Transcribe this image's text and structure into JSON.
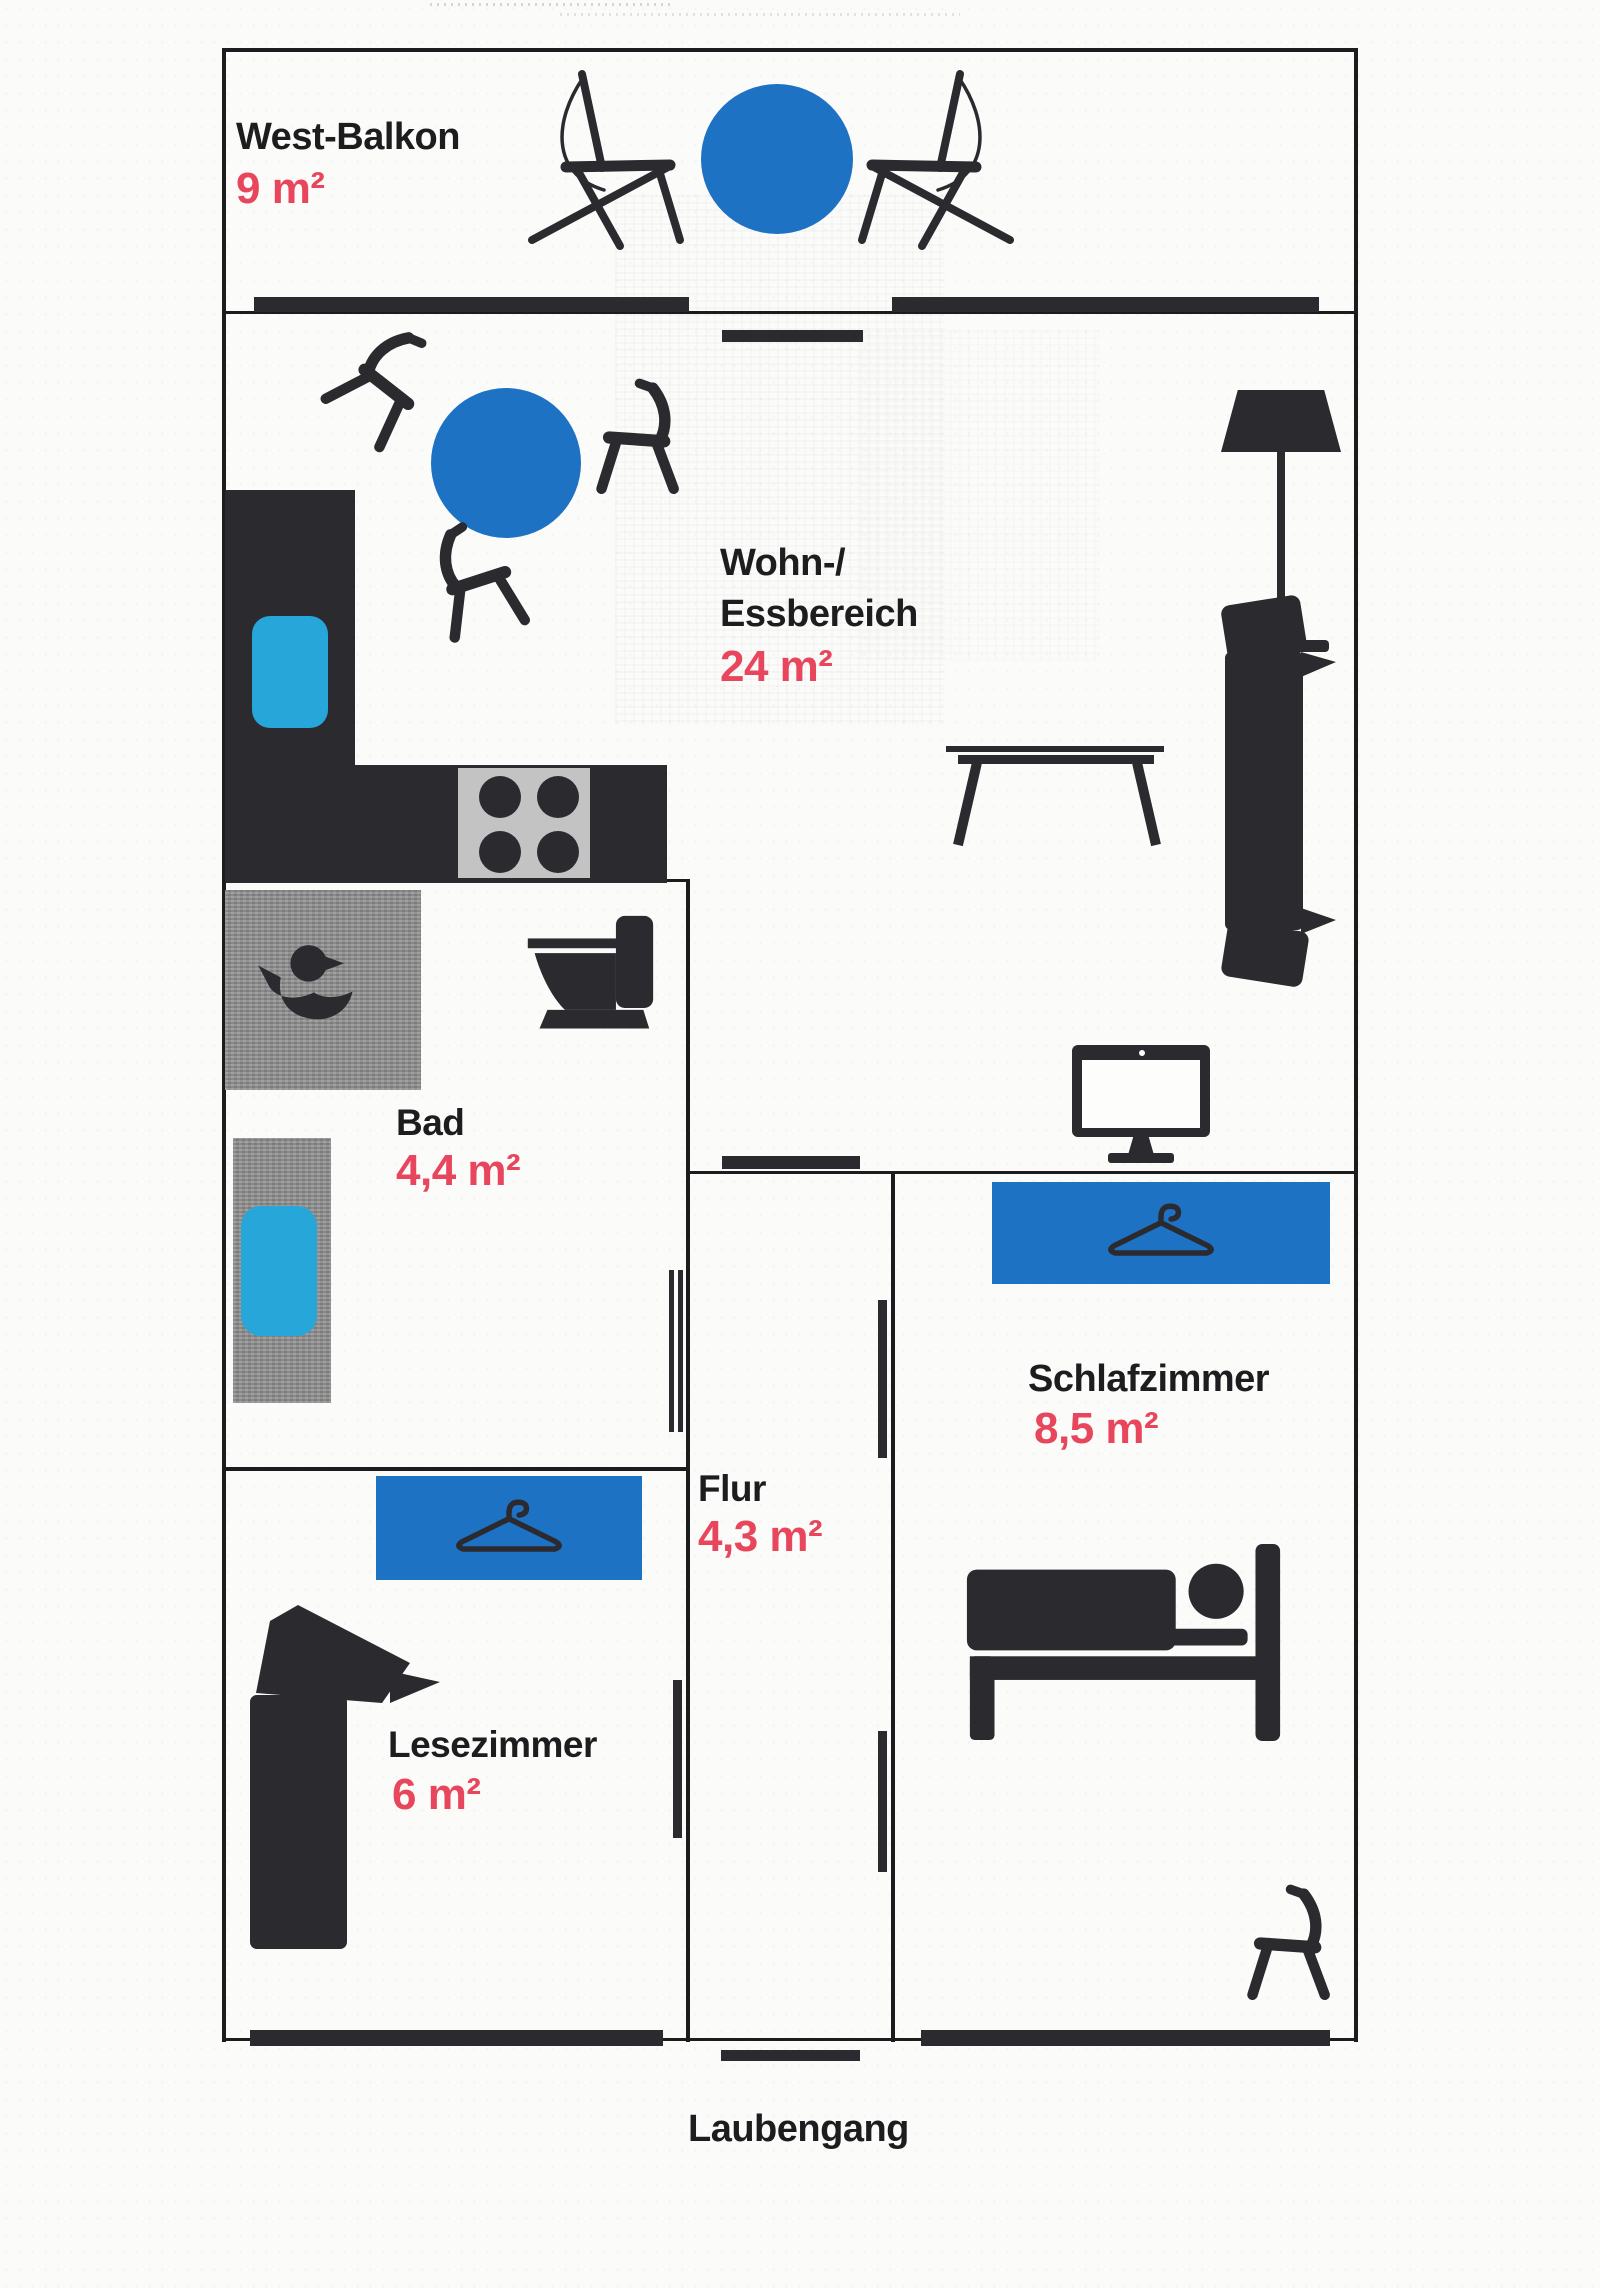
{
  "rooms": {
    "west_balkon": {
      "name": "West-Balkon",
      "area": "9 m²"
    },
    "wohn_essbereich": {
      "name_line1": "Wohn-/",
      "name_line2": "Essbereich",
      "area": "24 m²"
    },
    "bad": {
      "name": "Bad",
      "area": "4,4 m²"
    },
    "flur": {
      "name": "Flur",
      "area": "4,3 m²"
    },
    "schlafzimmer": {
      "name": "Schlafzimmer",
      "area": "8,5 m²"
    },
    "lesezimmer": {
      "name": "Lesezimmer",
      "area": "6 m²"
    }
  },
  "outside": {
    "laubengang": "Laubengang"
  },
  "colors": {
    "wall": "#1c1c1f",
    "furniture": "#2a2a2f",
    "accent_blue": "#1e72c4",
    "accent_cyan": "#27a6da",
    "area_red": "#e8465c",
    "mat_gray": "#8e8e8e",
    "stove_gray": "#c3c3c3",
    "background": "#fbfbf9"
  },
  "icons": [
    "lounge-chair-icon",
    "round-table-icon",
    "dining-chair-icon",
    "kitchen-counter",
    "sink-icon",
    "stove-icon",
    "burner-icon",
    "floor-lamp-icon",
    "sofa-icon",
    "coffee-table-icon",
    "monitor-icon",
    "duck-icon",
    "toilet-icon",
    "bathtub-icon",
    "hanger-icon",
    "wardrobe",
    "bed-icon",
    "armchair-icon",
    "door-leaf",
    "wall-segment"
  ]
}
